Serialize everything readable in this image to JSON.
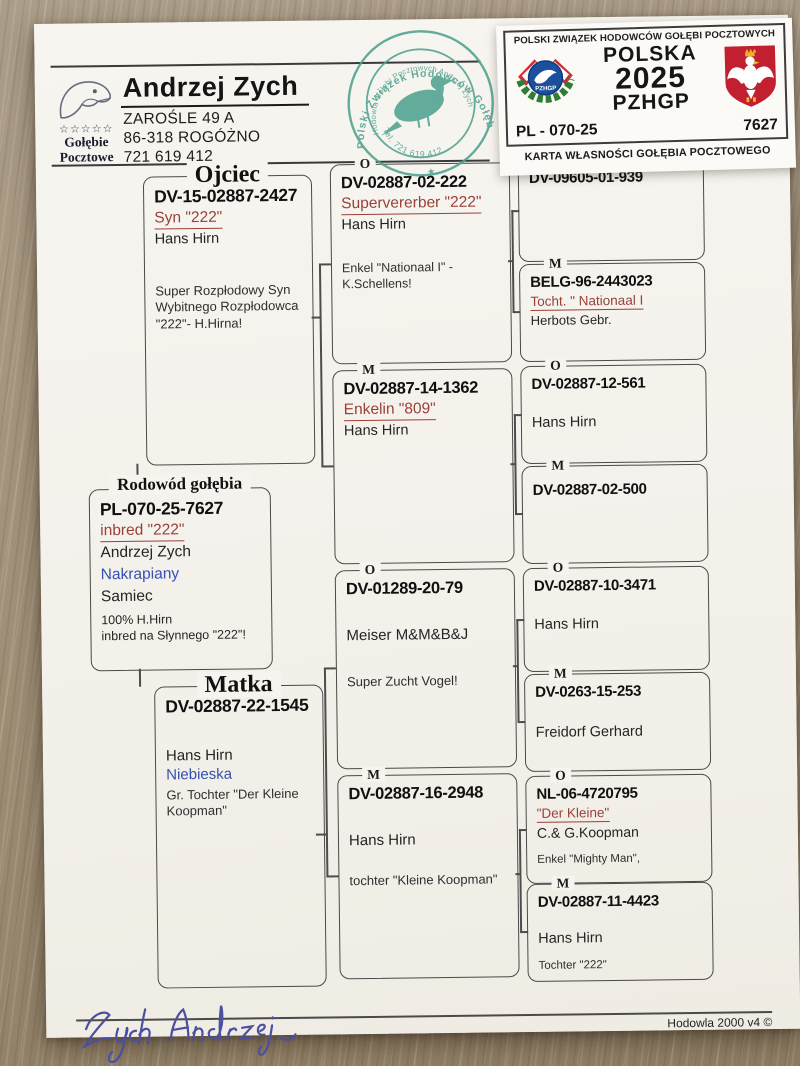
{
  "breeder": {
    "name": "Andrzej Zych",
    "address_line1": "ZAROŚLE  49 A",
    "address_line2": "86-318  ROGÓŻNO",
    "phone": "721 619 412",
    "logo": {
      "stars": "☆☆☆☆☆",
      "caption1": "Gołębie",
      "caption2": "Pocztowe"
    }
  },
  "stamp": {
    "ring_text": "Polski  Związek  Hodowców  Gołębi  Pocztowych",
    "inner_text": "Hodowla Gołębi Pocztowych Andrzej Zych",
    "phone_text": "Tel. 721 619 412",
    "color": "#4fa18f"
  },
  "card": {
    "header": "POLSKI ZWIĄZEK HODOWCÓW GOŁĘBI POCZTOWYCH",
    "country": "POLSKA",
    "year": "2025",
    "org": "PZHGP",
    "district_code": "PL - 070-25",
    "ring_number": "7627",
    "caption": "KARTA  WŁASNOŚCI GOŁĘBIA POCZTOWEGO",
    "emblem_label": "PZHGP"
  },
  "subject": {
    "section_title": "Rodowód gołębia",
    "ring": "PL-070-25-7627",
    "name": "inbred \"222\"",
    "owner": "Andrzej Zych",
    "color": "Nakrapiany",
    "sex": "Samiec",
    "note1": "100% H.Hirn",
    "note2": "inbred na Słynnego \"222\"!"
  },
  "father": {
    "section_title": "Ojciec",
    "ring": "DV-15-02887-2427",
    "name": "Syn \"222\"",
    "breeder": "Hans Hirn",
    "note": "Super Rozpłodowy Syn\nWybitnego Rozpłodowca\n\"222\"- H.Hirna!"
  },
  "mother": {
    "section_title": "Matka",
    "ring": "DV-02887-22-1545",
    "breeder": "Hans Hirn",
    "color": "Niebieska",
    "note": "Gr. Tochter \"Der Kleine\nKoopman\""
  },
  "gen2": [
    {
      "label": "O",
      "ring": "DV-02887-02-222",
      "name": "Supervererber \"222\"",
      "breeder": "Hans Hirn",
      "note": "Enkel \"Nationaal I\" -\nK.Schellens!"
    },
    {
      "label": "M",
      "ring": "DV-02887-14-1362",
      "name": "Enkelin \"809\"",
      "breeder": "Hans Hirn"
    },
    {
      "label": "O",
      "ring": "DV-01289-20-79",
      "breeder": "Meiser M&M&B&J",
      "note": "Super Zucht Vogel!"
    },
    {
      "label": "M",
      "ring": "DV-02887-16-2948",
      "breeder": "Hans Hirn",
      "note": "tochter \"Kleine Koopman\""
    }
  ],
  "gen3": [
    {
      "label": "O",
      "ring": "DV-09605-01-939"
    },
    {
      "label": "M",
      "ring": "BELG-96-2443023",
      "name": "Tocht. \" Nationaal I",
      "breeder": "Herbots Gebr."
    },
    {
      "label": "O",
      "ring": "DV-02887-12-561",
      "breeder": "Hans Hirn"
    },
    {
      "label": "M",
      "ring": "DV-02887-02-500"
    },
    {
      "label": "O",
      "ring": "DV-02887-10-3471",
      "breeder": "Hans Hirn"
    },
    {
      "label": "M",
      "ring": "DV-0263-15-253",
      "breeder": "Freidorf Gerhard"
    },
    {
      "label": "O",
      "ring": "NL-06-4720795",
      "name": "\"Der Kleine\"",
      "breeder": "C.& G.Koopman",
      "note": "Enkel \"Mighty Man\","
    },
    {
      "label": "M",
      "ring": "DV-02887-11-4423",
      "breeder": "Hans Hirn",
      "note": "Tochter \"222\""
    }
  ],
  "footer": {
    "signature": "Zych Andrzej",
    "software": "Hodowla 2000 v4 ©"
  }
}
